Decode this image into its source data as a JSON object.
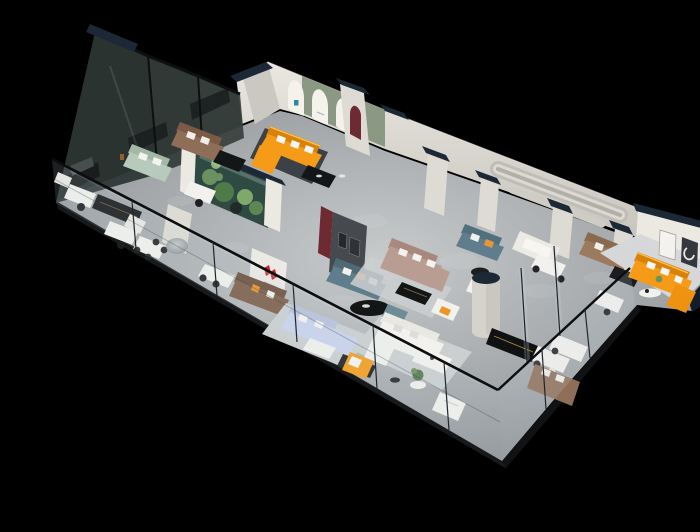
{
  "meta": {
    "description": "3D isometric cutaway render of a furniture showroom floor plan on a black background, with white partition walls capped in dark navy, tinted glass exterior walls, grey floors and sofas in orange, sage, teal, brown, taupe and lavender around display areas."
  },
  "palette": {
    "bg": "#000000",
    "floorLight": "#c7cacb",
    "floorMid": "#a2a6a9",
    "floorDark": "#84888b",
    "slabEdge": "#17191b",
    "wall": "#dedbd4",
    "wallLit": "#ece9e3",
    "wallShade": "#cbc8c2",
    "wallDark": "#b5b2ab",
    "navy": "#1d2836",
    "navyDeep": "#131c29",
    "glassFront": "#cddce4",
    "glassDarkPane": "#2e3634",
    "glassFrame": "#0b0d0e",
    "terrarium": "#2f4a43",
    "sage": "#8a9884",
    "archWhite": "#f4f2ea",
    "orange": "#f59b17",
    "orangeDeep": "#d9820a",
    "orangeHi": "#ffc14d",
    "teal": "#6d8d96",
    "steel": "#5f7d8c",
    "brown": "#8f6e58",
    "brownDark": "#7c5b45",
    "taupe": "#b99d92",
    "taupeDark": "#a8887c",
    "lavender": "#c9d2ea",
    "lavenderDeep": "#b7c1dd",
    "charcoal": "#46494e",
    "maroon": "#6e2a33",
    "redLogo": "#c2262a",
    "white": "#f2f1ed",
    "offWhite": "#e9e8e3",
    "furnBlack": "#141517",
    "plant": "#6c9160",
    "plantDark": "#4f7a4a",
    "gold": "#a8853e",
    "rugLight": "#cbcfd0",
    "rugDark": "#3c4147",
    "marble": "#d6d7d8",
    "logoBlue": "#2e86a8",
    "sageSofa": "#b7cabb"
  },
  "scene": {
    "objects": [
      "showroom-floor",
      "front-glass-balustrade",
      "back-glass-wall",
      "back-wall",
      "arched-display-wall",
      "vip-room-orange-sofa",
      "terrarium-plant-wall",
      "feature-wall",
      "reception-logo-wall",
      "grooved-wall-detail",
      "right-room-orange-sofa",
      "lavender-sectional",
      "taupe-sectional",
      "steel-blue-sofa",
      "sage-sofa",
      "brown-sofas",
      "white-sofa-group",
      "column-cylinder",
      "black-credenzas",
      "dining-sets",
      "desks-and-chairs",
      "navy-wall-caps",
      "rugs",
      "spotlight-pools"
    ]
  }
}
